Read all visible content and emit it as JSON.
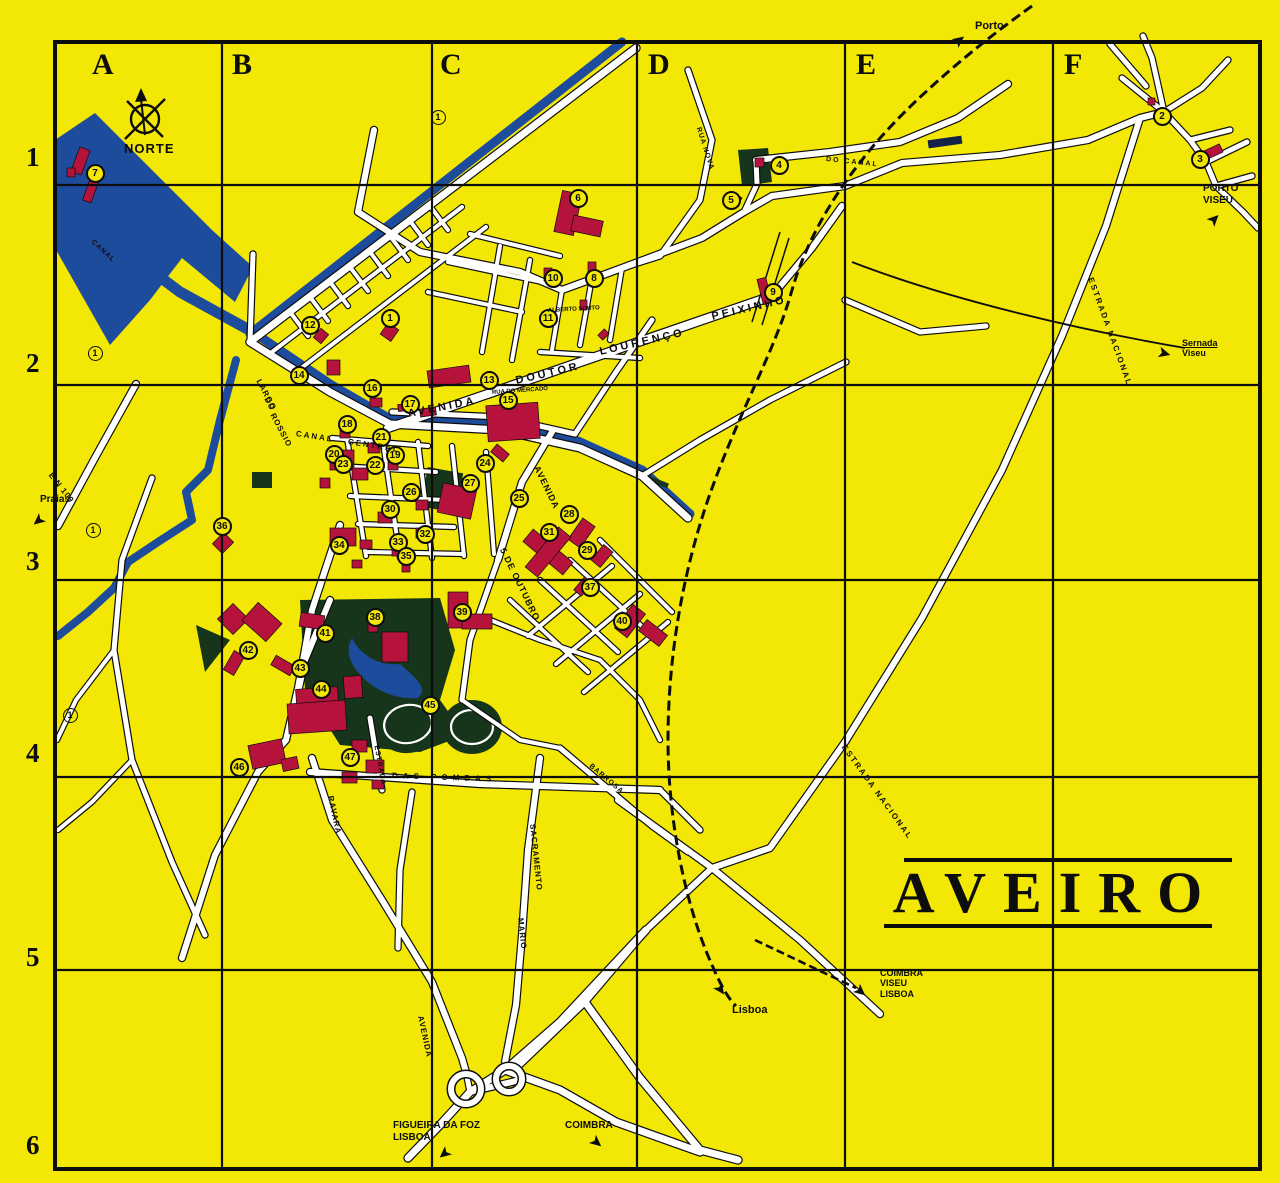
{
  "map": {
    "title": "AVEIRO",
    "compass_label": "NORTE",
    "colors": {
      "background": "#f2e705",
      "water": "#1e4c9c",
      "building": "#b5123c",
      "park": "#16351a",
      "road": "#ffffff",
      "line": "#0d0d0d"
    }
  },
  "grid": {
    "columns": [
      {
        "label": "A",
        "x": 92,
        "y": 48
      },
      {
        "label": "B",
        "x": 232,
        "y": 48
      },
      {
        "label": "C",
        "x": 440,
        "y": 48
      },
      {
        "label": "D",
        "x": 648,
        "y": 48
      },
      {
        "label": "E",
        "x": 856,
        "y": 48
      },
      {
        "label": "F",
        "x": 1064,
        "y": 48
      }
    ],
    "rows": [
      {
        "label": "1",
        "x": 26,
        "y": 142
      },
      {
        "label": "2",
        "x": 26,
        "y": 348
      },
      {
        "label": "3",
        "x": 26,
        "y": 546
      },
      {
        "label": "4",
        "x": 26,
        "y": 738
      },
      {
        "label": "5",
        "x": 26,
        "y": 942
      },
      {
        "label": "6",
        "x": 26,
        "y": 1130
      }
    ]
  },
  "markers": [
    [
      1,
      390,
      318
    ],
    [
      2,
      1162,
      116
    ],
    [
      3,
      1200,
      159
    ],
    [
      4,
      779,
      165
    ],
    [
      5,
      731,
      200
    ],
    [
      6,
      578,
      198
    ],
    [
      7,
      95,
      173
    ],
    [
      8,
      594,
      278
    ],
    [
      9,
      773,
      292
    ],
    [
      10,
      553,
      278
    ],
    [
      11,
      548,
      318
    ],
    [
      12,
      310,
      325
    ],
    [
      13,
      489,
      380
    ],
    [
      14,
      299,
      375
    ],
    [
      15,
      508,
      400
    ],
    [
      16,
      372,
      388
    ],
    [
      17,
      410,
      404
    ],
    [
      18,
      347,
      424
    ],
    [
      19,
      395,
      455
    ],
    [
      20,
      334,
      454
    ],
    [
      21,
      381,
      437
    ],
    [
      22,
      375,
      465
    ],
    [
      23,
      343,
      464
    ],
    [
      24,
      485,
      463
    ],
    [
      25,
      519,
      498
    ],
    [
      26,
      411,
      492
    ],
    [
      27,
      470,
      483
    ],
    [
      28,
      569,
      514
    ],
    [
      29,
      587,
      550
    ],
    [
      30,
      390,
      509
    ],
    [
      31,
      549,
      532
    ],
    [
      32,
      425,
      534
    ],
    [
      33,
      398,
      542
    ],
    [
      34,
      339,
      545
    ],
    [
      35,
      406,
      556
    ],
    [
      36,
      222,
      526
    ],
    [
      37,
      590,
      587
    ],
    [
      38,
      375,
      617
    ],
    [
      39,
      462,
      612
    ],
    [
      40,
      622,
      621
    ],
    [
      41,
      325,
      633
    ],
    [
      42,
      248,
      650
    ],
    [
      43,
      300,
      668
    ],
    [
      44,
      321,
      689
    ],
    [
      45,
      430,
      705
    ],
    [
      46,
      239,
      767
    ],
    [
      47,
      350,
      757
    ]
  ],
  "route_markers": [
    [
      "1",
      95,
      353
    ],
    [
      "1",
      93,
      530
    ],
    [
      "1",
      70,
      715
    ],
    [
      "1",
      438,
      117
    ]
  ],
  "street_labels": [
    {
      "text": "AVENIDA",
      "x": 408,
      "y": 409,
      "rot": -11,
      "size": 11,
      "ls": 3
    },
    {
      "text": "DOUTOR",
      "x": 516,
      "y": 376,
      "rot": -13,
      "size": 11,
      "ls": 3
    },
    {
      "text": "LOURENÇO",
      "x": 600,
      "y": 347,
      "rot": -13,
      "size": 11,
      "ls": 3
    },
    {
      "text": "PEIXINHO",
      "x": 712,
      "y": 312,
      "rot": -13,
      "size": 11,
      "ls": 3
    },
    {
      "text": "LARGO",
      "x": 258,
      "y": 376,
      "rot": 62,
      "size": 8,
      "ls": 1
    },
    {
      "text": "DO",
      "x": 266,
      "y": 394,
      "rot": 62,
      "size": 8,
      "ls": 1
    },
    {
      "text": "ROSSIO",
      "x": 272,
      "y": 410,
      "rot": 62,
      "size": 8,
      "ls": 1
    },
    {
      "text": "CANAL",
      "x": 296,
      "y": 430,
      "rot": 9,
      "size": 8,
      "ls": 2
    },
    {
      "text": "CENTRAL",
      "x": 348,
      "y": 438,
      "rot": 9,
      "size": 8,
      "ls": 2
    },
    {
      "text": "CANAL",
      "x": 92,
      "y": 238,
      "rot": 42,
      "size": 7,
      "ls": 1
    },
    {
      "text": "RUA DO MERCADO",
      "x": 492,
      "y": 390,
      "rot": -4,
      "size": 6,
      "ls": 0
    },
    {
      "text": "ALBERTO SOUTO",
      "x": 548,
      "y": 308,
      "rot": -3,
      "size": 6,
      "ls": 0
    },
    {
      "text": "AVENIDA",
      "x": 536,
      "y": 462,
      "rot": 64,
      "size": 9,
      "ls": 1
    },
    {
      "text": "5 DE OUTUBRO",
      "x": 502,
      "y": 544,
      "rot": 64,
      "size": 9,
      "ls": 1
    },
    {
      "text": "E N 109",
      "x": 50,
      "y": 470,
      "rot": 52,
      "size": 8,
      "ls": 1
    },
    {
      "text": "ESTRADA NACIONAL",
      "x": 1090,
      "y": 274,
      "rot": 70,
      "size": 8,
      "ls": 2
    },
    {
      "text": "ESTRADA NACIONAL",
      "x": 843,
      "y": 742,
      "rot": 54,
      "size": 8,
      "ls": 2
    },
    {
      "text": "DAS POMBAS",
      "x": 392,
      "y": 772,
      "rot": 2,
      "size": 8,
      "ls": 5
    },
    {
      "text": "RAVARA",
      "x": 330,
      "y": 792,
      "rot": 78,
      "size": 8,
      "ls": 1
    },
    {
      "text": "AVENIDA",
      "x": 420,
      "y": 1012,
      "rot": 78,
      "size": 8,
      "ls": 1
    },
    {
      "text": "SACRAMENTO",
      "x": 532,
      "y": 820,
      "rot": 84,
      "size": 8,
      "ls": 1
    },
    {
      "text": "MARIO",
      "x": 520,
      "y": 914,
      "rot": 84,
      "size": 8,
      "ls": 1
    },
    {
      "text": "BARROSA",
      "x": 590,
      "y": 762,
      "rot": 40,
      "size": 7,
      "ls": 1
    },
    {
      "text": "ESTRADA",
      "x": 376,
      "y": 742,
      "rot": 80,
      "size": 7,
      "ls": 1
    },
    {
      "text": "RUA NOVA",
      "x": 698,
      "y": 124,
      "rot": 72,
      "size": 7,
      "ls": 1
    },
    {
      "text": "DO CANAL",
      "x": 826,
      "y": 156,
      "rot": 6,
      "size": 7,
      "ls": 2
    }
  ],
  "signs": [
    {
      "id": "porto",
      "lines": [
        "Porto"
      ],
      "x": 975,
      "y": 20,
      "size": 11,
      "arrow": {
        "x": 953,
        "y": 33,
        "rot": -38
      }
    },
    {
      "id": "porto-viseu",
      "lines": [
        "PORTO",
        "VISEU"
      ],
      "x": 1203,
      "y": 183,
      "size": 10,
      "arrow": {
        "x": 1208,
        "y": 212,
        "rot": -45
      }
    },
    {
      "id": "sernada-viseu",
      "lines": [
        "Sernada",
        "Viseu"
      ],
      "x": 1182,
      "y": 338,
      "size": 9,
      "underline_first": true,
      "arrow": {
        "x": 1158,
        "y": 346,
        "rot": 15
      }
    },
    {
      "id": "coimbra-viseu-lisboa",
      "lines": [
        "COIMBRA",
        "VISEU",
        "LISBOA"
      ],
      "x": 880,
      "y": 968,
      "size": 9,
      "arrow": {
        "x": 854,
        "y": 984,
        "rot": 40
      }
    },
    {
      "id": "lisboa",
      "lines": [
        "Lisboa"
      ],
      "x": 732,
      "y": 1004,
      "size": 11,
      "arrow": {
        "x": 714,
        "y": 982,
        "rot": 55
      }
    },
    {
      "id": "figueira-da-foz-lisboa",
      "lines": [
        "FIGUEIRA DA FOZ",
        "LISBOA"
      ],
      "x": 393,
      "y": 1120,
      "size": 10,
      "arrow": {
        "x": 438,
        "y": 1146,
        "rot": 140
      }
    },
    {
      "id": "coimbra",
      "lines": [
        "COIMBRA"
      ],
      "x": 565,
      "y": 1120,
      "size": 10,
      "arrow": {
        "x": 590,
        "y": 1135,
        "rot": 40
      }
    },
    {
      "id": "praias",
      "lines": [
        "Praias"
      ],
      "x": 40,
      "y": 494,
      "size": 10,
      "arrow": {
        "x": 32,
        "y": 513,
        "rot": 140
      }
    }
  ]
}
